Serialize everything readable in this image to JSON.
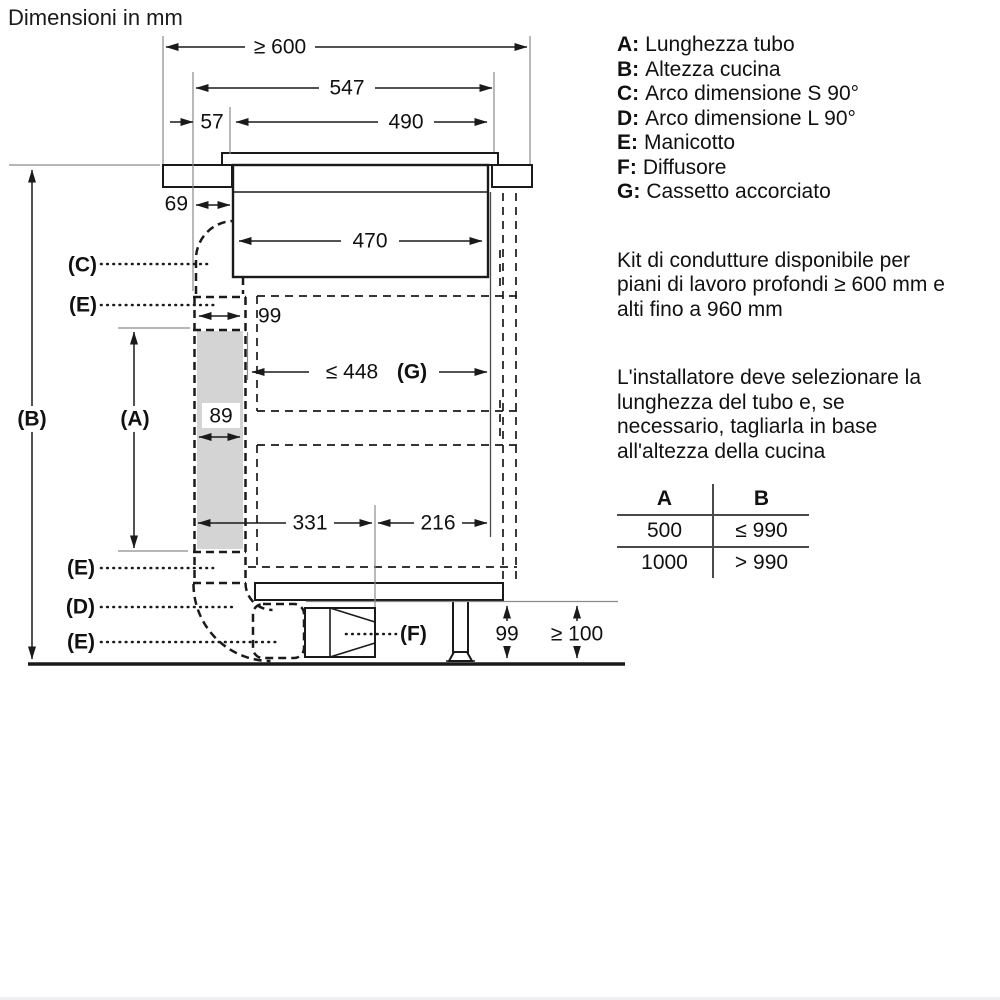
{
  "title": "Dimensioni in mm",
  "legend": {
    "items": [
      {
        "key": "A:",
        "label": "Lunghezza tubo"
      },
      {
        "key": "B:",
        "label": "Altezza cucina"
      },
      {
        "key": "C:",
        "label": "Arco dimensione S 90°"
      },
      {
        "key": "D:",
        "label": "Arco dimensione L 90°"
      },
      {
        "key": "E:",
        "label": "Manicotto"
      },
      {
        "key": "F:",
        "label": "Diffusore"
      },
      {
        "key": "G:",
        "label": "Cassetto accorciato"
      }
    ]
  },
  "notes": {
    "note1_lines": [
      "Kit di condutture disponibile per",
      "piani di lavoro profondi ≥ 600 mm e",
      "alti fino a 960 mm"
    ],
    "note2_lines": [
      "L'installatore deve selezionare la",
      "lunghezza del tubo e, se",
      "necessario, tagliarla in base",
      "all'altezza della cucina"
    ]
  },
  "table": {
    "col_a_header": "A",
    "col_b_header": "B",
    "rows": [
      [
        "500",
        "≤ 990"
      ],
      [
        "1000",
        "> 990"
      ]
    ]
  },
  "diagram": {
    "dims": {
      "worktop_min_depth": "≥ 600",
      "hob_total_width": "547",
      "front_offset": "57",
      "hob_body_width": "490",
      "hob_inner_width": "470",
      "duct_front_gap": "69",
      "sleeve_top_width": "99",
      "duct_depth": "89",
      "drawer_max": "≤ 448",
      "drawer_ref": "(G)",
      "rear_depth": "331",
      "front_depth": "216",
      "diffuser_height": "99",
      "plinth_min": "≥ 100"
    },
    "labels": {
      "a": "(A)",
      "b": "(B)",
      "c": "(C)",
      "d": "(D)",
      "e": "(E)",
      "f": "(F)"
    }
  },
  "colors": {
    "line": "#1a1a1a",
    "gray_line": "#8a8a8a",
    "duct_fill": "#d4d4d4"
  }
}
